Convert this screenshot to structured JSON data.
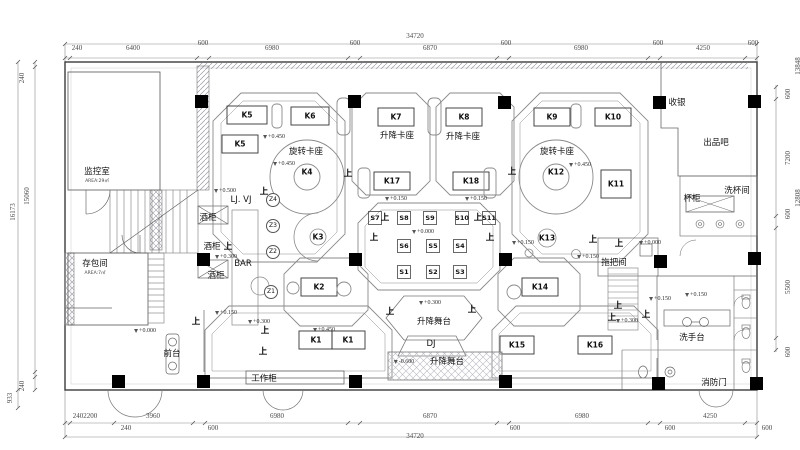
{
  "title": "bar-floor-plan",
  "colors": {
    "line": "#6e6e6e",
    "light": "#a8a8b0",
    "dark": "#000000",
    "wall_hatch": "#9a9aa6"
  },
  "dimensions": {
    "top": {
      "total": "34720",
      "chain": [
        "240",
        "6400",
        "600",
        "6980",
        "600",
        "6870",
        "600",
        "6980",
        "600",
        "4250",
        "600"
      ]
    },
    "bottom": {
      "total": "34720",
      "chain_inner": [
        "2402200",
        "3960",
        "6980",
        "6870",
        "6980",
        "4250"
      ],
      "chain_outer": [
        "240",
        "600",
        "600",
        "600",
        "600"
      ]
    },
    "left": {
      "total": "16173",
      "chain": [
        "240",
        "15060",
        "240",
        "933"
      ]
    },
    "right": {
      "totals": [
        "13848",
        "12808"
      ],
      "chain": [
        "600",
        "7200",
        "600",
        "5500",
        "600"
      ]
    }
  },
  "rooms": [
    "监控室",
    "存包间",
    "前台",
    "工作柜",
    "酒柜",
    "BAR",
    "LJ. VJ",
    "收银",
    "出品吧",
    "洗杯间",
    "杯柜",
    "拖把间",
    "洗手台",
    "消防门",
    "升降卡座",
    "旋转卡座",
    "升降舞台",
    "DJ"
  ],
  "tables": [
    "K1",
    "K2",
    "K3",
    "K4",
    "K5",
    "K6",
    "K7",
    "K8",
    "K9",
    "K10",
    "K11",
    "K12",
    "K13",
    "K14",
    "K15",
    "K16",
    "K17",
    "K18",
    "S1",
    "S2",
    "S3",
    "S4",
    "S5",
    "S6",
    "S7",
    "S8",
    "S9",
    "S10",
    "S11"
  ],
  "zone_tags": [
    "Z1",
    "Z2",
    "Z3",
    "Z4"
  ],
  "elevation_values": [
    "+0.000",
    "+0.150",
    "+0.300",
    "+0.450",
    "+0.500",
    "-0.600"
  ],
  "up_marker_text": "上",
  "annotations": [
    {
      "t": "34720",
      "x": 415,
      "y": 36,
      "kind": "dim",
      "n": "dim-top-total"
    },
    {
      "t": "240",
      "x": 77,
      "y": 48,
      "kind": "dim",
      "n": "dim-top"
    },
    {
      "t": "6400",
      "x": 133,
      "y": 48,
      "kind": "dim",
      "n": "dim-top"
    },
    {
      "t": "600",
      "x": 203,
      "y": 43,
      "kind": "dim",
      "n": "dim-top"
    },
    {
      "t": "6980",
      "x": 272,
      "y": 48,
      "kind": "dim",
      "n": "dim-top"
    },
    {
      "t": "600",
      "x": 355,
      "y": 43,
      "kind": "dim",
      "n": "dim-top"
    },
    {
      "t": "6870",
      "x": 430,
      "y": 48,
      "kind": "dim",
      "n": "dim-top"
    },
    {
      "t": "600",
      "x": 506,
      "y": 43,
      "kind": "dim",
      "n": "dim-top"
    },
    {
      "t": "6980",
      "x": 581,
      "y": 48,
      "kind": "dim",
      "n": "dim-top"
    },
    {
      "t": "600",
      "x": 658,
      "y": 43,
      "kind": "dim",
      "n": "dim-top"
    },
    {
      "t": "4250",
      "x": 703,
      "y": 48,
      "kind": "dim",
      "n": "dim-top"
    },
    {
      "t": "600",
      "x": 753,
      "y": 43,
      "kind": "dim",
      "n": "dim-top"
    },
    {
      "t": "2402200",
      "x": 85,
      "y": 416,
      "kind": "dim",
      "n": "dim-bottom"
    },
    {
      "t": "3960",
      "x": 153,
      "y": 416,
      "kind": "dim",
      "n": "dim-bottom"
    },
    {
      "t": "6980",
      "x": 277,
      "y": 416,
      "kind": "dim",
      "n": "dim-bottom"
    },
    {
      "t": "6870",
      "x": 430,
      "y": 416,
      "kind": "dim",
      "n": "dim-bottom"
    },
    {
      "t": "6980",
      "x": 582,
      "y": 416,
      "kind": "dim",
      "n": "dim-bottom"
    },
    {
      "t": "4250",
      "x": 710,
      "y": 416,
      "kind": "dim",
      "n": "dim-bottom"
    },
    {
      "t": "240",
      "x": 126,
      "y": 428,
      "kind": "dim",
      "n": "dim-bottom"
    },
    {
      "t": "600",
      "x": 213,
      "y": 428,
      "kind": "dim",
      "n": "dim-bottom"
    },
    {
      "t": "600",
      "x": 515,
      "y": 428,
      "kind": "dim",
      "n": "dim-bottom"
    },
    {
      "t": "600",
      "x": 670,
      "y": 428,
      "kind": "dim",
      "n": "dim-bottom"
    },
    {
      "t": "600",
      "x": 767,
      "y": 428,
      "kind": "dim",
      "n": "dim-bottom"
    },
    {
      "t": "34720",
      "x": 415,
      "y": 436,
      "kind": "dim",
      "n": "dim-bottom-total"
    },
    {
      "t": "240",
      "x": 22,
      "y": 78,
      "kind": "dimv",
      "n": "dim-left"
    },
    {
      "t": "15060",
      "x": 27,
      "y": 196,
      "kind": "dimv",
      "n": "dim-left"
    },
    {
      "t": "16173",
      "x": 13,
      "y": 212,
      "kind": "dimv",
      "n": "dim-left-total"
    },
    {
      "t": "240",
      "x": 22,
      "y": 386,
      "kind": "dimv",
      "n": "dim-left"
    },
    {
      "t": "933",
      "x": 10,
      "y": 398,
      "kind": "dimv",
      "n": "dim-left"
    },
    {
      "t": "13848",
      "x": 798,
      "y": 66,
      "kind": "dimv",
      "n": "dim-right-total"
    },
    {
      "t": "600",
      "x": 788,
      "y": 94,
      "kind": "dimv",
      "n": "dim-right"
    },
    {
      "t": "7200",
      "x": 788,
      "y": 158,
      "kind": "dimv",
      "n": "dim-right"
    },
    {
      "t": "12808",
      "x": 798,
      "y": 198,
      "kind": "dimv",
      "n": "dim-right-total"
    },
    {
      "t": "600",
      "x": 788,
      "y": 214,
      "kind": "dimv",
      "n": "dim-right"
    },
    {
      "t": "5500",
      "x": 788,
      "y": 287,
      "kind": "dimv",
      "n": "dim-right"
    },
    {
      "t": "600",
      "x": 788,
      "y": 352,
      "kind": "dimv",
      "n": "dim-right"
    },
    {
      "t": "监控室",
      "x": 97,
      "y": 172,
      "kind": "cjk",
      "n": "room-label-monitor"
    },
    {
      "t": "AREA:29㎡",
      "x": 97,
      "y": 182,
      "kind": "sub",
      "n": "room-area-monitor"
    },
    {
      "t": "存包间",
      "x": 95,
      "y": 264,
      "kind": "cjk",
      "n": "room-label-storage"
    },
    {
      "t": "AREA:7㎡",
      "x": 95,
      "y": 274,
      "kind": "sub",
      "n": "room-area-storage"
    },
    {
      "t": "LJ. VJ",
      "x": 241,
      "y": 200,
      "kind": "cjk",
      "n": "label-ljvj"
    },
    {
      "t": "酒柜",
      "x": 208,
      "y": 218,
      "kind": "cjk",
      "n": "label-wine-cabinet"
    },
    {
      "t": "酒柜",
      "x": 212,
      "y": 247,
      "kind": "cjk",
      "n": "label-wine-cabinet"
    },
    {
      "t": "酒柜",
      "x": 216,
      "y": 276,
      "kind": "cjk",
      "n": "label-wine-cabinet"
    },
    {
      "t": "BAR",
      "x": 243,
      "y": 264,
      "kind": "cjk",
      "n": "label-bar"
    },
    {
      "t": "收银",
      "x": 677,
      "y": 103,
      "kind": "cjk",
      "n": "label-cashier"
    },
    {
      "t": "出品吧",
      "x": 716,
      "y": 143,
      "kind": "cjk",
      "n": "label-service-bar"
    },
    {
      "t": "洗杯间",
      "x": 737,
      "y": 191,
      "kind": "cjk",
      "n": "label-cup-washing"
    },
    {
      "t": "杯柜",
      "x": 692,
      "y": 199,
      "kind": "cjk",
      "n": "label-cup-cabinet"
    },
    {
      "t": "旋转卡座",
      "x": 306,
      "y": 152,
      "kind": "cjk",
      "n": "label-rotating-booth"
    },
    {
      "t": "旋转卡座",
      "x": 557,
      "y": 152,
      "kind": "cjk",
      "n": "label-rotating-booth"
    },
    {
      "t": "升降卡座",
      "x": 397,
      "y": 136,
      "kind": "cjk",
      "n": "label-lift-booth"
    },
    {
      "t": "升降卡座",
      "x": 463,
      "y": 137,
      "kind": "cjk",
      "n": "label-lift-booth"
    },
    {
      "t": "升降舞台",
      "x": 434,
      "y": 322,
      "kind": "cjk",
      "n": "label-lift-stage"
    },
    {
      "t": "升降舞台",
      "x": 447,
      "y": 362,
      "kind": "cjk",
      "n": "label-lift-stage"
    },
    {
      "t": "DJ",
      "x": 431,
      "y": 344,
      "kind": "cjk",
      "n": "label-dj"
    },
    {
      "t": "拖把间",
      "x": 614,
      "y": 263,
      "kind": "cjk",
      "n": "label-mop-room"
    },
    {
      "t": "洗手台",
      "x": 692,
      "y": 338,
      "kind": "cjk",
      "n": "label-washstand"
    },
    {
      "t": "消防门",
      "x": 714,
      "y": 383,
      "kind": "cjk",
      "n": "label-fire-door"
    },
    {
      "t": "前台",
      "x": 172,
      "y": 354,
      "kind": "cjk",
      "n": "label-front-desk"
    },
    {
      "t": "工作柜",
      "x": 264,
      "y": 379,
      "kind": "cjk",
      "n": "label-work-cabinet"
    },
    {
      "t": "K5",
      "x": 247,
      "y": 115,
      "kind": "k",
      "n": "table-K5"
    },
    {
      "t": "K6",
      "x": 310,
      "y": 116,
      "kind": "k",
      "n": "table-K6"
    },
    {
      "t": "K5",
      "x": 240,
      "y": 144,
      "kind": "k",
      "n": "table-K5"
    },
    {
      "t": "K7",
      "x": 396,
      "y": 117,
      "kind": "k",
      "n": "table-K7"
    },
    {
      "t": "K8",
      "x": 464,
      "y": 117,
      "kind": "k",
      "n": "table-K8"
    },
    {
      "t": "K9",
      "x": 552,
      "y": 117,
      "kind": "k",
      "n": "table-K9"
    },
    {
      "t": "K10",
      "x": 613,
      "y": 117,
      "kind": "k",
      "n": "table-K10"
    },
    {
      "t": "K11",
      "x": 616,
      "y": 184,
      "kind": "k",
      "n": "table-K11"
    },
    {
      "t": "K17",
      "x": 392,
      "y": 181,
      "kind": "k",
      "n": "table-K17"
    },
    {
      "t": "K18",
      "x": 471,
      "y": 181,
      "kind": "k",
      "n": "table-K18"
    },
    {
      "t": "K4",
      "x": 307,
      "y": 172,
      "kind": "k",
      "n": "table-K4"
    },
    {
      "t": "K12",
      "x": 556,
      "y": 172,
      "kind": "k",
      "n": "table-K12"
    },
    {
      "t": "K3",
      "x": 318,
      "y": 237,
      "kind": "k",
      "n": "table-K3"
    },
    {
      "t": "K13",
      "x": 547,
      "y": 238,
      "kind": "k",
      "n": "table-K13"
    },
    {
      "t": "K2",
      "x": 319,
      "y": 287,
      "kind": "k",
      "n": "table-K2"
    },
    {
      "t": "K14",
      "x": 540,
      "y": 287,
      "kind": "k",
      "n": "table-K14"
    },
    {
      "t": "K1",
      "x": 316,
      "y": 340,
      "kind": "k",
      "n": "table-K1"
    },
    {
      "t": "K1",
      "x": 348,
      "y": 340,
      "kind": "k",
      "n": "table-K1"
    },
    {
      "t": "K15",
      "x": 517,
      "y": 345,
      "kind": "k",
      "n": "table-K15"
    },
    {
      "t": "K16",
      "x": 595,
      "y": 345,
      "kind": "k",
      "n": "table-K16"
    },
    {
      "t": "S7",
      "x": 375,
      "y": 218,
      "kind": "s",
      "n": "table-S7"
    },
    {
      "t": "S8",
      "x": 404,
      "y": 218,
      "kind": "s",
      "n": "table-S8"
    },
    {
      "t": "S9",
      "x": 430,
      "y": 218,
      "kind": "s",
      "n": "table-S9"
    },
    {
      "t": "S10",
      "x": 462,
      "y": 218,
      "kind": "s",
      "n": "table-S10"
    },
    {
      "t": "S11",
      "x": 489,
      "y": 218,
      "kind": "s",
      "n": "table-S11"
    },
    {
      "t": "S6",
      "x": 404,
      "y": 246,
      "kind": "s",
      "n": "table-S6"
    },
    {
      "t": "S5",
      "x": 433,
      "y": 246,
      "kind": "s",
      "n": "table-S5"
    },
    {
      "t": "S4",
      "x": 460,
      "y": 246,
      "kind": "s",
      "n": "table-S4"
    },
    {
      "t": "S1",
      "x": 404,
      "y": 272,
      "kind": "s",
      "n": "table-S1"
    },
    {
      "t": "S2",
      "x": 433,
      "y": 272,
      "kind": "s",
      "n": "table-S2"
    },
    {
      "t": "S3",
      "x": 460,
      "y": 272,
      "kind": "s",
      "n": "table-S3"
    },
    {
      "t": "Z4",
      "x": 273,
      "y": 200,
      "kind": "z",
      "n": "zone-tag-Z4"
    },
    {
      "t": "Z3",
      "x": 273,
      "y": 226,
      "kind": "z",
      "n": "zone-tag-Z3"
    },
    {
      "t": "Z2",
      "x": 273,
      "y": 252,
      "kind": "z",
      "n": "zone-tag-Z2"
    },
    {
      "t": "Z1",
      "x": 271,
      "y": 292,
      "kind": "z",
      "n": "zone-tag-Z1"
    },
    {
      "t": "+0.450",
      "x": 274,
      "y": 137,
      "kind": "elev",
      "n": "elevation-mark"
    },
    {
      "t": "+0.450",
      "x": 284,
      "y": 164,
      "kind": "elev",
      "n": "elevation-mark"
    },
    {
      "t": "+0.500",
      "x": 225,
      "y": 191,
      "kind": "elev",
      "n": "elevation-mark"
    },
    {
      "t": "+0.300",
      "x": 226,
      "y": 257,
      "kind": "elev",
      "n": "elevation-mark"
    },
    {
      "t": "+0.450",
      "x": 580,
      "y": 165,
      "kind": "elev",
      "n": "elevation-mark"
    },
    {
      "t": "+0.150",
      "x": 396,
      "y": 199,
      "kind": "elev",
      "n": "elevation-mark"
    },
    {
      "t": "+0.150",
      "x": 476,
      "y": 199,
      "kind": "elev",
      "n": "elevation-mark"
    },
    {
      "t": "+0.000",
      "x": 423,
      "y": 232,
      "kind": "elev",
      "n": "elevation-mark"
    },
    {
      "t": "+0.150",
      "x": 523,
      "y": 243,
      "kind": "elev",
      "n": "elevation-mark"
    },
    {
      "t": "+0.150",
      "x": 588,
      "y": 257,
      "kind": "elev",
      "n": "elevation-mark"
    },
    {
      "t": "+0.000",
      "x": 650,
      "y": 243,
      "kind": "elev",
      "n": "elevation-mark"
    },
    {
      "t": "+0.150",
      "x": 660,
      "y": 299,
      "kind": "elev",
      "n": "elevation-mark"
    },
    {
      "t": "+0.150",
      "x": 696,
      "y": 295,
      "kind": "elev",
      "n": "elevation-mark"
    },
    {
      "t": "+0.300",
      "x": 627,
      "y": 321,
      "kind": "elev",
      "n": "elevation-mark"
    },
    {
      "t": "+0.150",
      "x": 226,
      "y": 313,
      "kind": "elev",
      "n": "elevation-mark"
    },
    {
      "t": "+0.300",
      "x": 259,
      "y": 322,
      "kind": "elev",
      "n": "elevation-mark"
    },
    {
      "t": "+0.000",
      "x": 145,
      "y": 331,
      "kind": "elev",
      "n": "elevation-mark"
    },
    {
      "t": "+0.450",
      "x": 324,
      "y": 330,
      "kind": "elev",
      "n": "elevation-mark"
    },
    {
      "t": "+0.300",
      "x": 430,
      "y": 303,
      "kind": "elev",
      "n": "elevation-mark"
    },
    {
      "t": "-0.600",
      "x": 404,
      "y": 362,
      "kind": "elev",
      "n": "elevation-mark"
    },
    {
      "t": "上",
      "x": 264,
      "y": 192,
      "kind": "up",
      "n": "up-marker"
    },
    {
      "t": "上",
      "x": 348,
      "y": 174,
      "kind": "up",
      "n": "up-marker"
    },
    {
      "t": "上",
      "x": 512,
      "y": 172,
      "kind": "up",
      "n": "up-marker"
    },
    {
      "t": "上",
      "x": 228,
      "y": 247,
      "kind": "up",
      "n": "up-marker"
    },
    {
      "t": "上",
      "x": 385,
      "y": 218,
      "kind": "up",
      "n": "up-marker"
    },
    {
      "t": "上",
      "x": 478,
      "y": 218,
      "kind": "up",
      "n": "up-marker"
    },
    {
      "t": "上",
      "x": 374,
      "y": 238,
      "kind": "up",
      "n": "up-marker"
    },
    {
      "t": "上",
      "x": 490,
      "y": 238,
      "kind": "up",
      "n": "up-marker"
    },
    {
      "t": "上",
      "x": 593,
      "y": 240,
      "kind": "up",
      "n": "up-marker"
    },
    {
      "t": "上",
      "x": 619,
      "y": 244,
      "kind": "up",
      "n": "up-marker"
    },
    {
      "t": "上",
      "x": 618,
      "y": 306,
      "kind": "up",
      "n": "up-marker"
    },
    {
      "t": "上",
      "x": 612,
      "y": 318,
      "kind": "up",
      "n": "up-marker"
    },
    {
      "t": "上",
      "x": 646,
      "y": 315,
      "kind": "up",
      "n": "up-marker"
    },
    {
      "t": "上",
      "x": 196,
      "y": 322,
      "kind": "up",
      "n": "up-marker"
    },
    {
      "t": "上",
      "x": 265,
      "y": 331,
      "kind": "up",
      "n": "up-marker"
    },
    {
      "t": "上",
      "x": 263,
      "y": 352,
      "kind": "up",
      "n": "up-marker"
    },
    {
      "t": "上",
      "x": 390,
      "y": 312,
      "kind": "up",
      "n": "up-marker"
    },
    {
      "t": "上",
      "x": 472,
      "y": 310,
      "kind": "up",
      "n": "up-marker"
    }
  ]
}
